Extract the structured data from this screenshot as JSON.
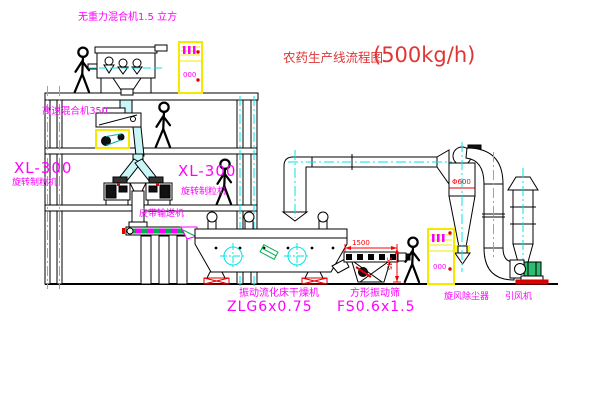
{
  "drawing": {
    "title_cn": "农药生产线流程图",
    "title_capacity": "(500kg/h)"
  },
  "labels": {
    "top_mixer": "无重力混合机1.5 立方",
    "hs_mixer": "高速混合机350",
    "xl_left_model": "XL-300",
    "xl_left_name": "旋转制粒机",
    "xl_mid_model": "XL-300",
    "xl_mid_name": "旋转制粒机",
    "belt": "皮带输送机",
    "dryer_name": "振动流化床干燥机",
    "dryer_model": "ZLG6x0.75",
    "sieve_name": "方形振动筛",
    "sieve_model": "FS0.6x1.5",
    "cyclone": "旋风除尘器",
    "fan": "引风机"
  },
  "dimensions": {
    "cyclone_diameter": "Φ600",
    "sieve_length": "1500",
    "sieve_height": "545"
  },
  "cabinets": {
    "top_display": "000",
    "right_display": "000"
  },
  "colors": {
    "background": "#ffffff",
    "line": "#000000",
    "label_magenta": "#ff00ff",
    "title_red": "#e03535",
    "dimension_red": "#ff0000",
    "centerline_cyan": "#00e5e5",
    "cabinet_yellow": "#f5e900",
    "hatch_green": "#00b050",
    "pipe_fill": "#c9f6f6"
  }
}
